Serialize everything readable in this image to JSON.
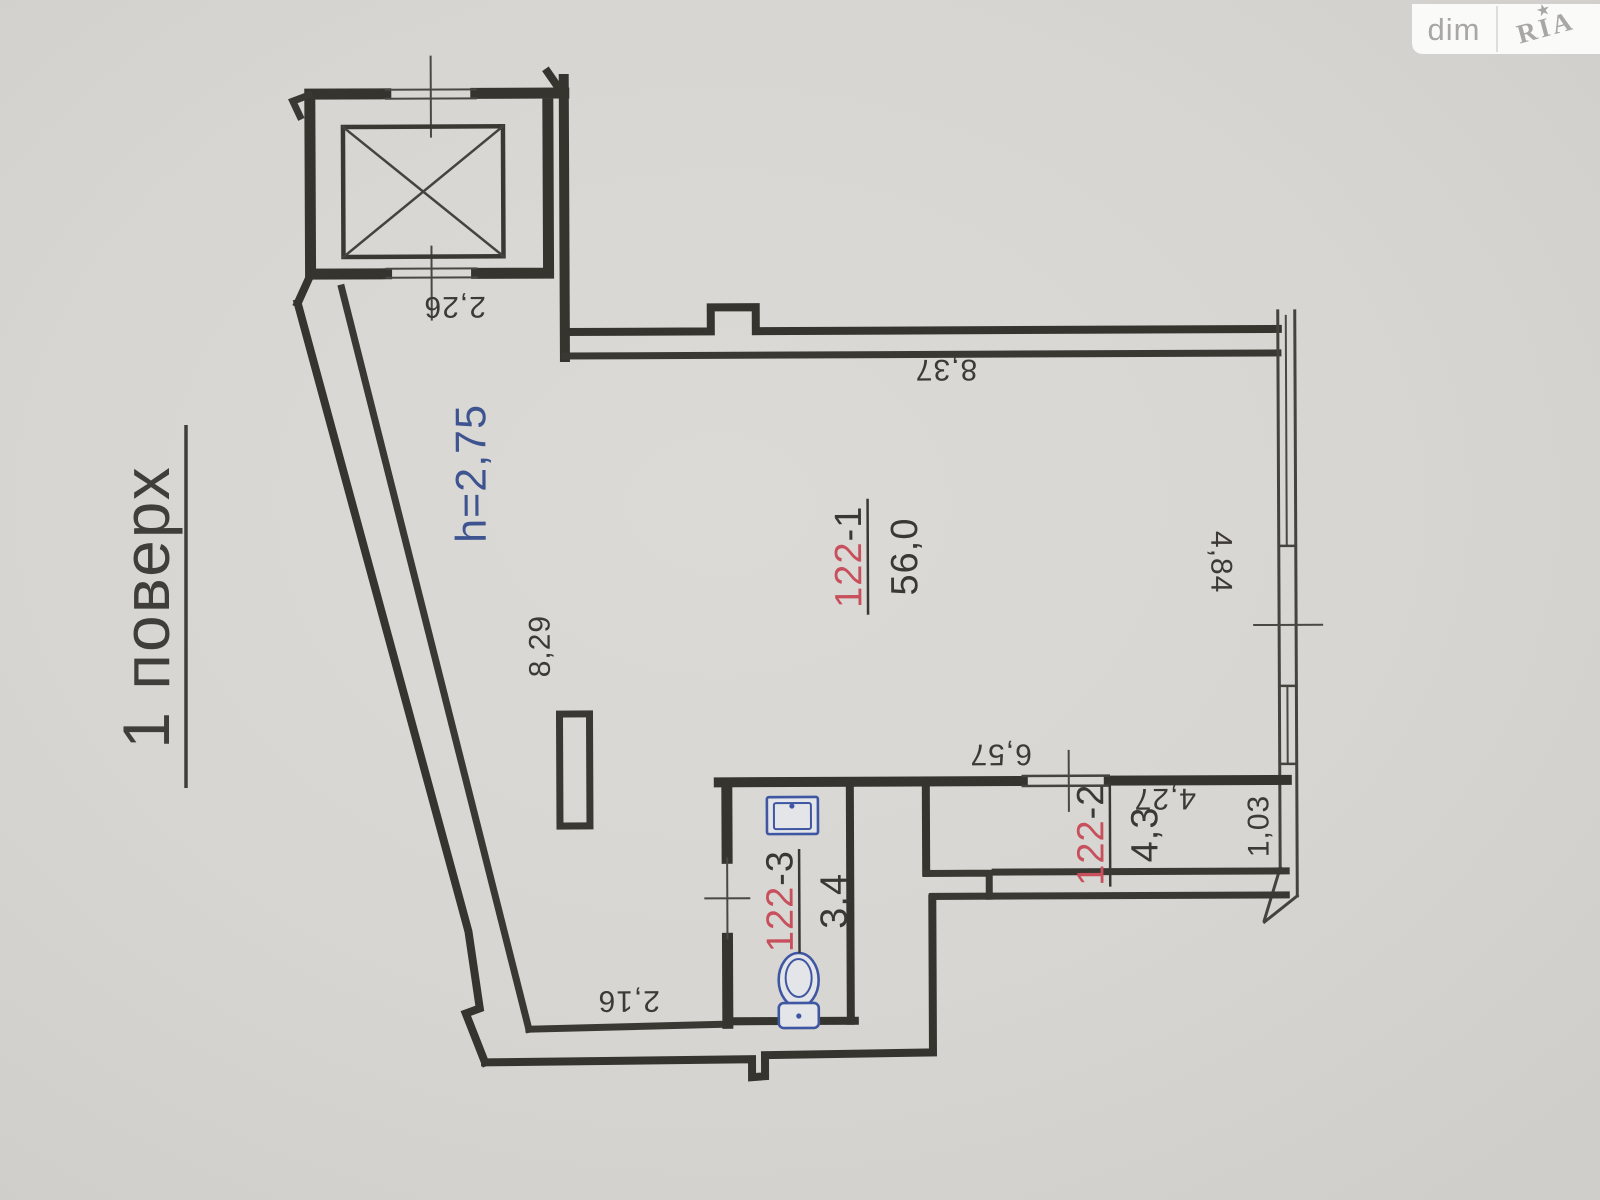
{
  "watermark": {
    "left": "dim",
    "right": "RIA",
    "star": "★"
  },
  "page": {
    "floor_label": "1 поверх"
  },
  "plan": {
    "height_note": "h=2,75",
    "rooms": [
      {
        "id_red": "122",
        "id_suffix": "-1",
        "area": "56,0"
      },
      {
        "id_red": "122",
        "id_suffix": "-2",
        "area": "4,3"
      },
      {
        "id_red": "122",
        "id_suffix": "-3",
        "area": "3,4"
      }
    ],
    "dimensions": {
      "elevator_width": "2,26",
      "top_wall": "8,37",
      "left_wall": "8,29",
      "right_wall": "4,84",
      "balcony_wall": "6,57",
      "balcony_length": "4,27",
      "balcony_width": "1,03",
      "bottom_wall": "2,16"
    },
    "colors": {
      "room_id_red": "#c7505c",
      "height_blue": "#3e5490",
      "fixture_blue": "#3f57a2",
      "line_dark": "#36342f",
      "paper": "#d8d6d2"
    }
  }
}
